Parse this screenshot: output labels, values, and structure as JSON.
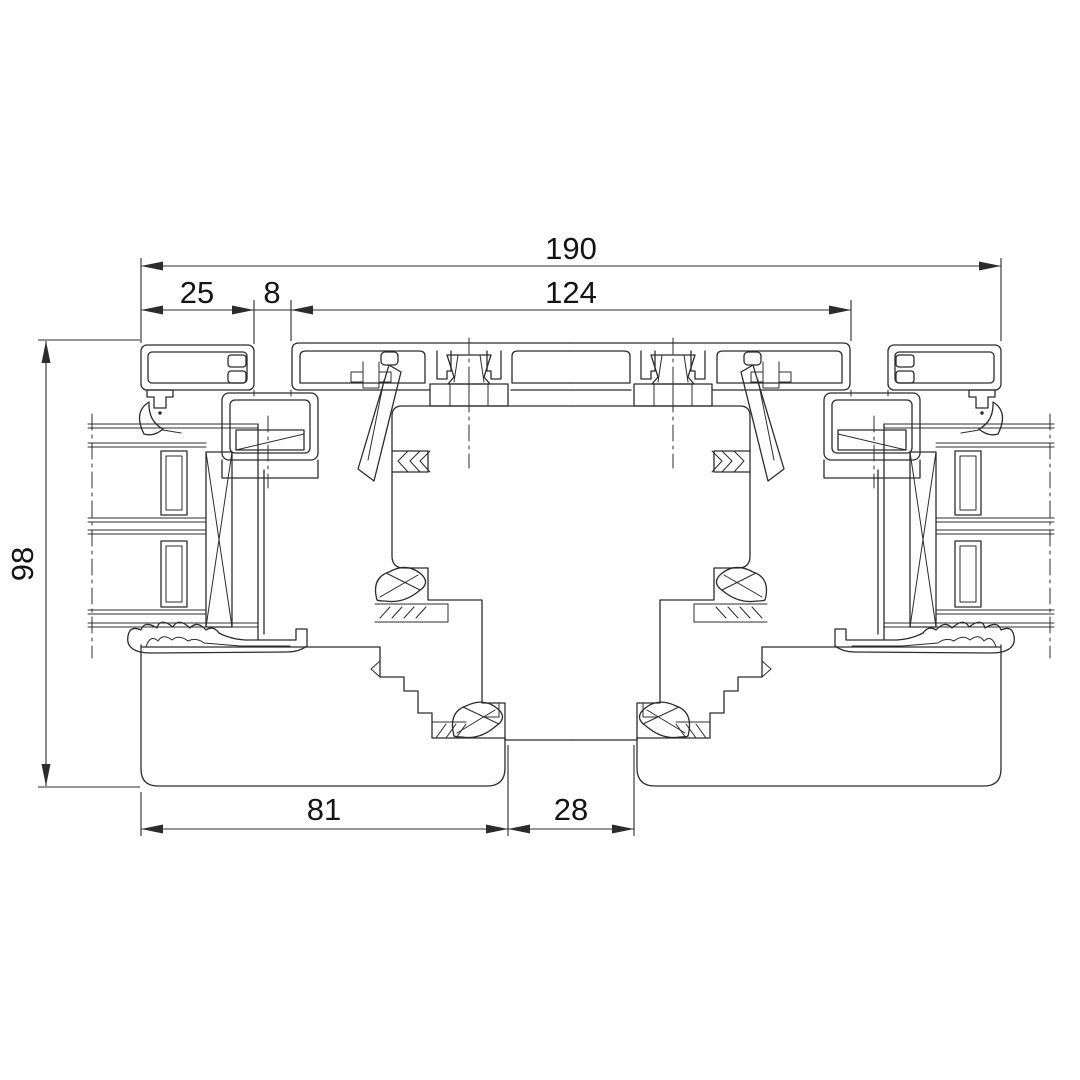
{
  "drawing": {
    "background": "#ffffff",
    "line_color": "#2c2c2c",
    "text_color": "#141414",
    "dimensions": {
      "overall_width": "190",
      "left_cap_width": "25",
      "joint_gap": "8",
      "center_profile_width": "124",
      "frame_height": "98",
      "sill_left_width": "81",
      "sill_center_width": "28"
    }
  }
}
